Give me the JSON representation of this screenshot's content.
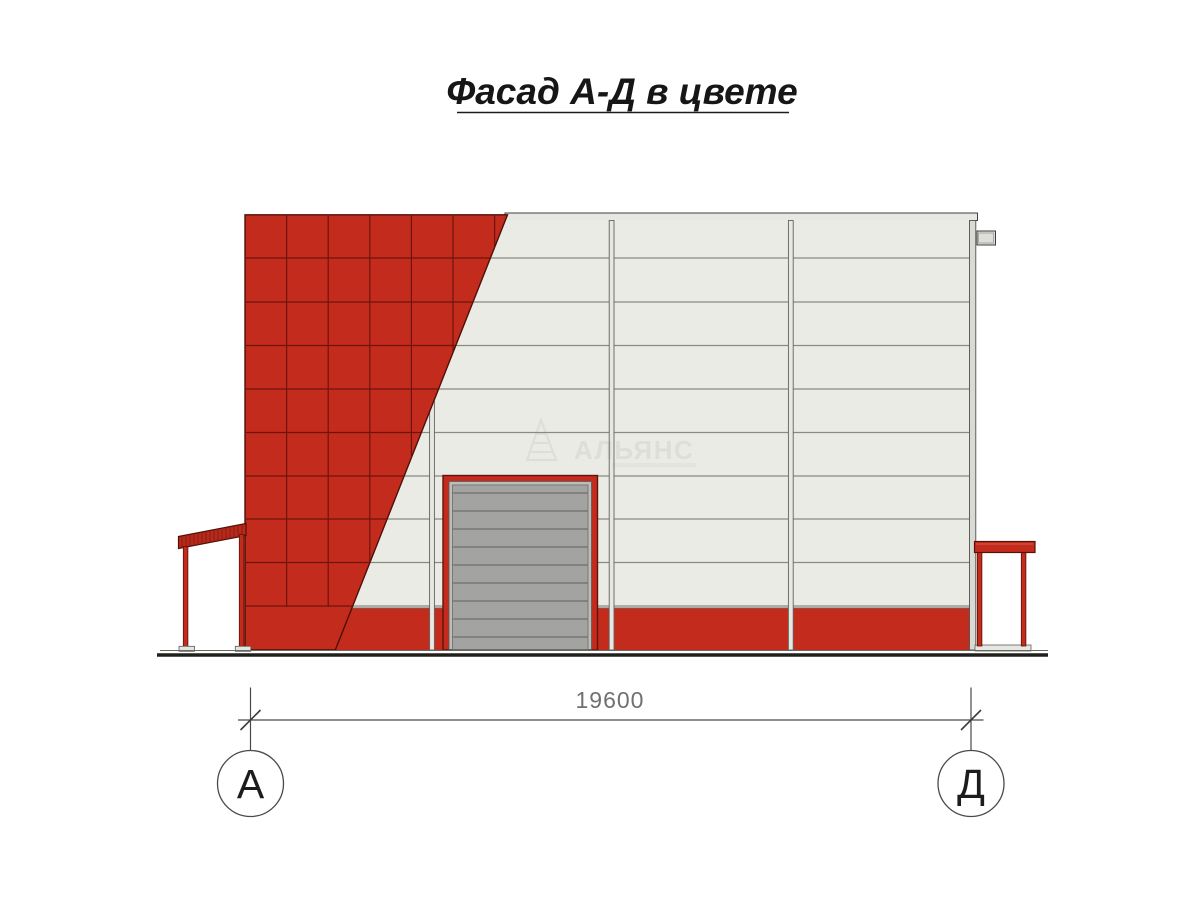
{
  "title": {
    "text": "Фасад А-Д в цвете"
  },
  "dimension": {
    "label": "19600"
  },
  "axis_markers": {
    "left": "А",
    "right": "Д"
  },
  "watermark": {
    "brand": "АЛЬЯНС"
  },
  "colors": {
    "facade-red": "#c32b1d",
    "tile-grid": "#6d150c",
    "red-outline": "#4f0f08",
    "panel-bg": "#ebebe6",
    "panel-line": "#8a8a80",
    "cap-fill": "#e7e7e3",
    "column-fill": "#d9d9d5",
    "door-gray": "#a3a3a1",
    "door-slat-line": "#6d6d6b",
    "door-frame-light": "#bcbcb8",
    "ground-dark": "#20201c",
    "line-gray": "#4a4a4a",
    "dim-text": "#707070",
    "title-color": "#161616",
    "watermark-gray": "#8f8f85"
  }
}
